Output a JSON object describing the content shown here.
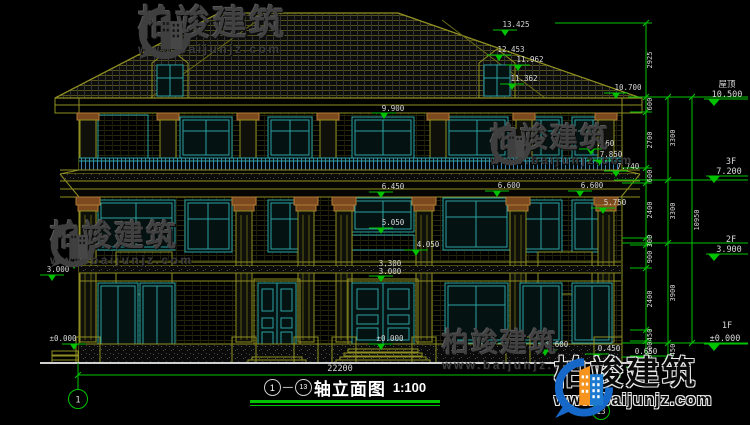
{
  "watermark": {
    "brand": "柏竣建筑",
    "url": "www.baijunjz.com"
  },
  "title": {
    "from": "1",
    "dash": "—",
    "to": "13",
    "name": "轴立面图",
    "scale": "1:100"
  },
  "axes": {
    "left": "1",
    "right": "13"
  },
  "dims": {
    "overall_width": "22200",
    "right_top": "2925",
    "right_inner": [
      "600",
      "2700",
      "600",
      "2400",
      "300",
      "900",
      "2400",
      "450",
      "600",
      "450"
    ],
    "right_floors": [
      "3300",
      "3300",
      "3900",
      "450"
    ],
    "right_total": "10950"
  },
  "levels": [
    {
      "name": "屋顶",
      "elev": "10.500"
    },
    {
      "name": "3F",
      "elev": "7.200"
    },
    {
      "name": "2F",
      "elev": "3.900"
    },
    {
      "name": "1F",
      "elev": "±0.000"
    }
  ],
  "spot_elevations": [
    "13.425",
    "12.453",
    "11.962",
    "11.362",
    "10.700",
    "9.900",
    "8.360",
    "7.850",
    "7.740",
    "6.600",
    "6.600",
    "6.450",
    "5.750",
    "5.050",
    "4.050",
    "3.450",
    "3.300",
    "3.000",
    "3.000",
    "±0.000",
    "±0.000",
    "0.600",
    "0.450",
    "0.650"
  ]
}
